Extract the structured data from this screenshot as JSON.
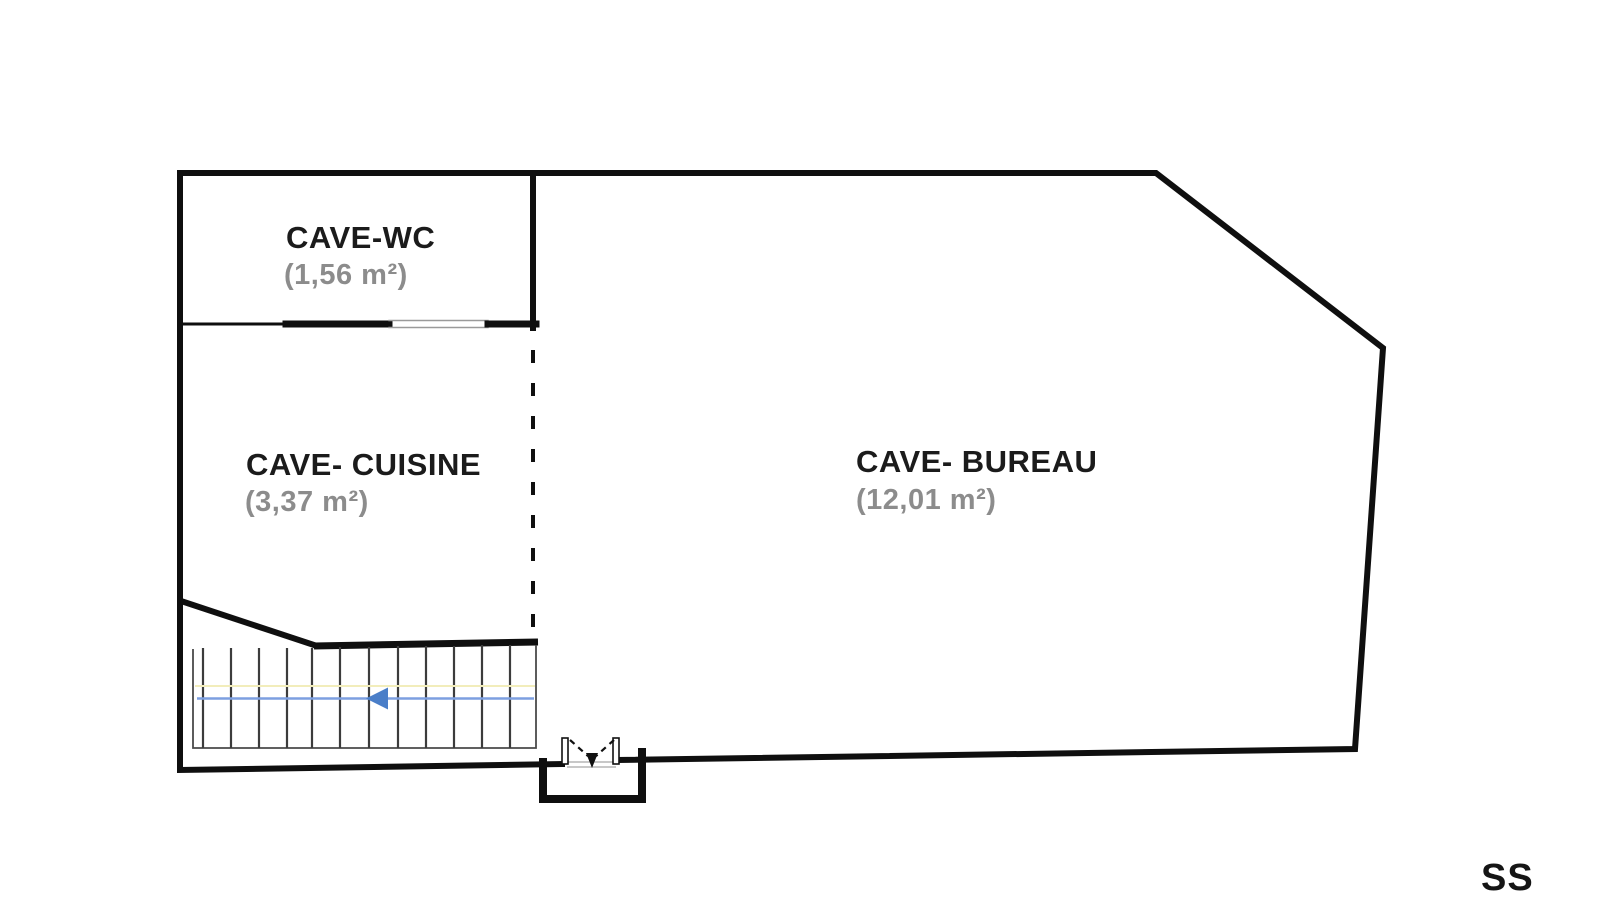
{
  "plan": {
    "level_label": "SS",
    "rooms": [
      {
        "name": "CAVE-WC",
        "area": "(1,56 m²)"
      },
      {
        "name": "CAVE- CUISINE",
        "area": "(3,37 m²)"
      },
      {
        "name": "CAVE- BUREAU",
        "area": "(12,01 m²)"
      }
    ],
    "stairs": {
      "steps": 13,
      "direction_arrow": "left"
    },
    "colors": {
      "background": "#ffffff",
      "walls": "#0f0f0f",
      "room_name_text": "#1b1b1b",
      "area_text": "#8c8c8c",
      "stair_tread": "#3c3c3c",
      "stair_outline": "#4a4a4a",
      "stair_guide_line": "#f2edbb",
      "arrow_line": "#7d9fe0",
      "arrow_head": "#4a7ec8",
      "door_opening_line": "#9a9a9a"
    }
  }
}
